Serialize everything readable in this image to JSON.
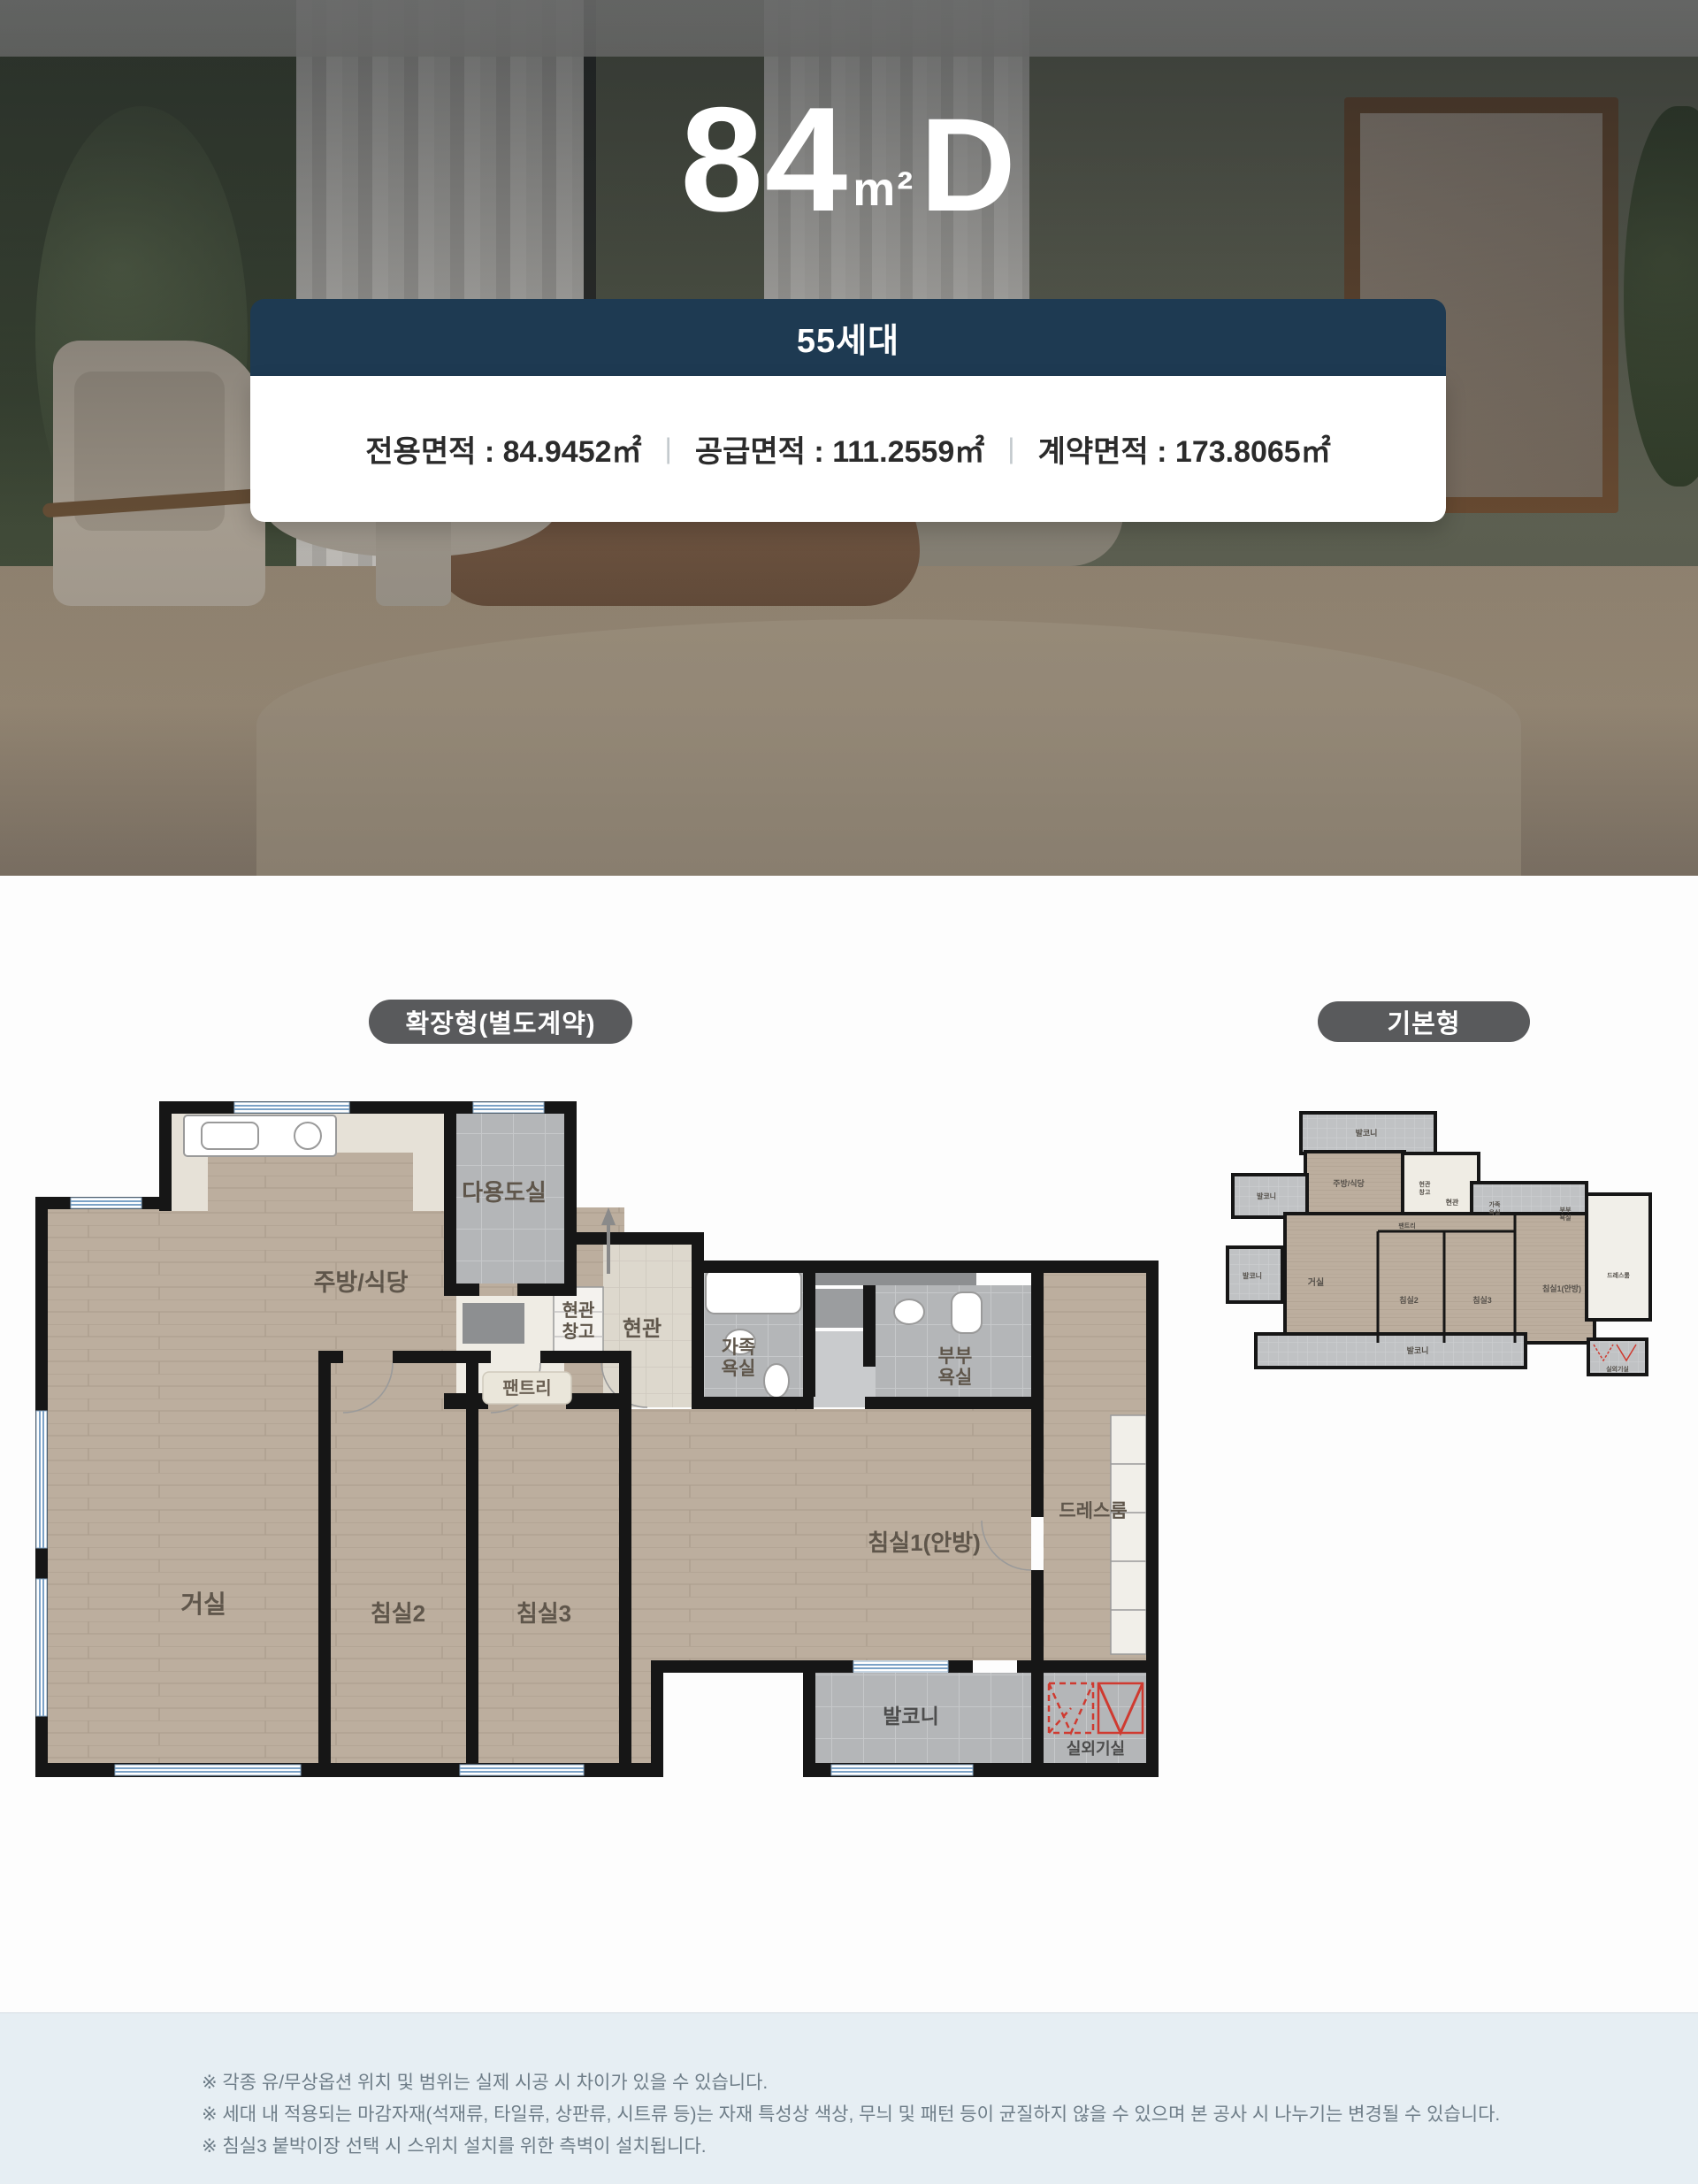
{
  "hero": {
    "title": {
      "number": "84",
      "unit": "m²",
      "type": "D"
    },
    "households_badge": "55세대",
    "areas": {
      "colon": " : ",
      "separator": "|",
      "exclusive": {
        "label": "전용면적",
        "value": "84.9452㎡"
      },
      "supply": {
        "label": "공급면적",
        "value": "111.2559㎡"
      },
      "contract": {
        "label": "계약면적",
        "value": "173.8065㎡"
      }
    }
  },
  "plans": {
    "extended": {
      "badge": "확장형(별도계약)",
      "rooms": {
        "utility": "다용도실",
        "kitchen": "주방/식당",
        "entry_storage_l1": "현관",
        "entry_storage_l2": "창고",
        "entry": "현관",
        "pantry": "팬트리",
        "family_bath_l1": "가족",
        "family_bath_l2": "욕실",
        "master_bath_l1": "부부",
        "master_bath_l2": "욕실",
        "dress_room": "드레스룸",
        "bedroom1": "침실1(안방)",
        "living": "거실",
        "bedroom2": "침실2",
        "bedroom3": "침실3",
        "balcony": "발코니",
        "ac_unit_room": "실외기실"
      }
    },
    "basic": {
      "badge": "기본형",
      "rooms": {
        "balcony_top": "발코니",
        "kitchen": "주방/식당",
        "balcony_left": "발코니",
        "entry_storage_l1": "현관",
        "entry_storage_l2": "창고",
        "entry": "현관",
        "family_bath_l1": "가족",
        "family_bath_l2": "욕실",
        "master_bath_l1": "부부",
        "master_bath_l2": "욕실",
        "pantry": "팬트리",
        "living": "거실",
        "balcony_left2": "발코니",
        "bedroom2": "침실2",
        "bedroom3": "침실3",
        "bedroom1": "침실1(안방)",
        "dress_room": "드레스룸",
        "balcony_bottom": "발코니",
        "ac_unit_room": "실외기실"
      }
    }
  },
  "footer": {
    "notes": [
      "※ 각종 유/무상옵션 위치 및 범위는 실제 시공 시 차이가 있을 수 있습니다.",
      "※ 세대 내 적용되는 마감자재(석재류, 타일류, 상판류, 시트류 등)는 자재 특성상 색상, 무늬 및 패턴 등이 균질하지 않을 수 있으며 본 공사 시 나누기는 변경될 수 있습니다.",
      "※ 침실3 붙박이장 선택 시 스위치 설치를 위한 측벽이 설치됩니다."
    ]
  },
  "colors": {
    "navy": "#1e3a52",
    "badge_gray": "#595a5c",
    "footer_bg": "#e6eef3",
    "wall": "#161616",
    "window_blue": "#7ba2c7",
    "accent_red": "#cf3a30"
  }
}
